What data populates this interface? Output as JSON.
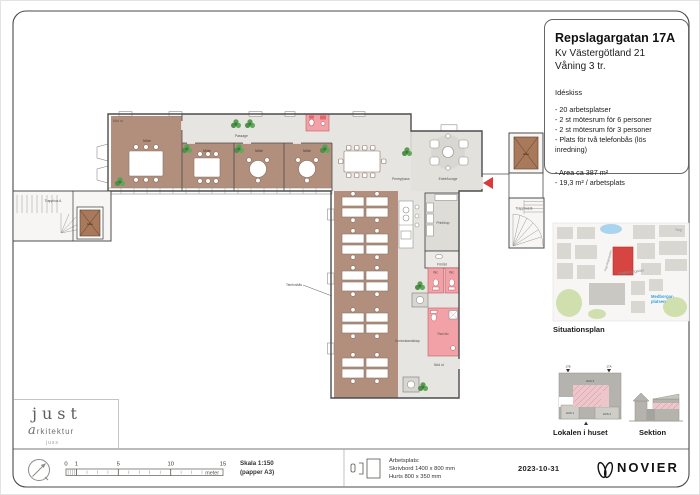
{
  "title_block": {
    "address": "Repslagargatan 17A",
    "kvarter": "Kv Västergötland 21",
    "floor": "Våning 3 tr.",
    "sketch_type": "Idéskiss",
    "program": [
      "- 20 arbetsplatser",
      "- 2 st mötesrum för 6 personer",
      "- 2 st mötesrum för 3 personer",
      "- Plats för två telefonbås (lös inredning)"
    ],
    "area_line1": "- Area ca 387 m²",
    "area_line2": "- 19,3 m² / arbetsplats"
  },
  "plan": {
    "mote": "Möte",
    "passage": "Passage",
    "pentry_paus": "Pentry/paus",
    "entre_lounge": "Entré/lounge",
    "print_kop": "Print/kop",
    "forrad": "Förråd",
    "wc": "Wc",
    "rwc_du": "Rwc/du",
    "kontorslandskap": "Kontorslandskap",
    "telefonbas": "Telefonbås",
    "trapphus_a": "Trapphus A",
    "trapphus_b": "Trapphus B",
    "hiss": "Hiss",
    "nod_ut": "Nöd ut"
  },
  "map": {
    "caption": "Situationsplan",
    "street_1": "Högbergsgatan",
    "street_2": "Repslagargatan",
    "metro_line1": "Medborgar-",
    "metro_line2": "platsen",
    "torg": "Torg"
  },
  "lokalen": {
    "caption": "Lokalen i huset",
    "hus1": "HUS 1",
    "hus2": "HUS 2",
    "hus3": "HUS 3",
    "entrance_a": "17A",
    "entrance_b": "17B"
  },
  "sektion": {
    "caption": "Sektion"
  },
  "footer": {
    "scale_ticks": [
      "0",
      "1",
      "5",
      "10",
      "15"
    ],
    "meter": "meter",
    "scale_line1": "Skala 1:150",
    "scale_line2": "(papper A3)",
    "workplace_title": "Arbetsplats:",
    "workplace_desk": "Skrivbord 1400 x 800 mm",
    "workplace_drawer": "Hurts 800 x 350 mm",
    "date": "2023-10-31",
    "brand": "NOVIER"
  },
  "architect_logo": {
    "name": "just",
    "subtitle": "arkitektur",
    "tagline": "juss"
  },
  "colors": {
    "room_brown": "#b28f7d",
    "floor_gray": "#e7e5e1",
    "wc_pink": "#f2a2a7",
    "accent_red": "#d64541",
    "plant_green": "#5a9c54",
    "metro_blue": "#35a3dc"
  }
}
